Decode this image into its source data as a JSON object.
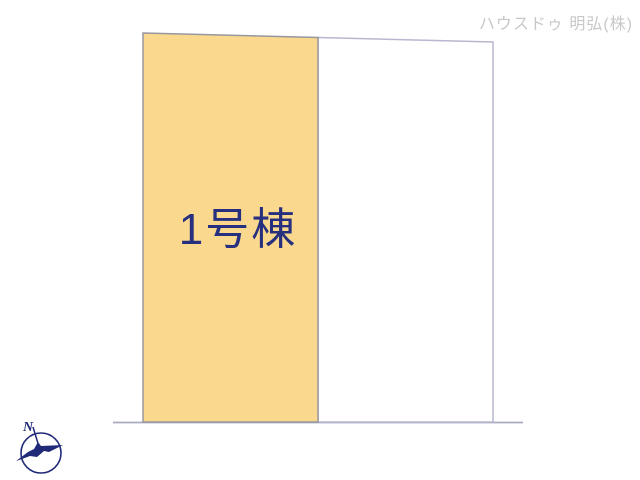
{
  "header": {
    "company_label": "ハウスドゥ 明弘(株)",
    "color": "#c8c8c8"
  },
  "plot": {
    "parcels": [
      {
        "id": "1",
        "label": "1号棟",
        "fill": "#fad98f",
        "stroke": "#97979f",
        "label_color": "#27307e"
      },
      {
        "id": "2",
        "label": "",
        "fill": "#ffffff",
        "stroke": "#b7b7cf"
      }
    ],
    "road_line_color": "#a9a9bf"
  },
  "compass": {
    "north_label": "N",
    "color": "#202a78"
  }
}
